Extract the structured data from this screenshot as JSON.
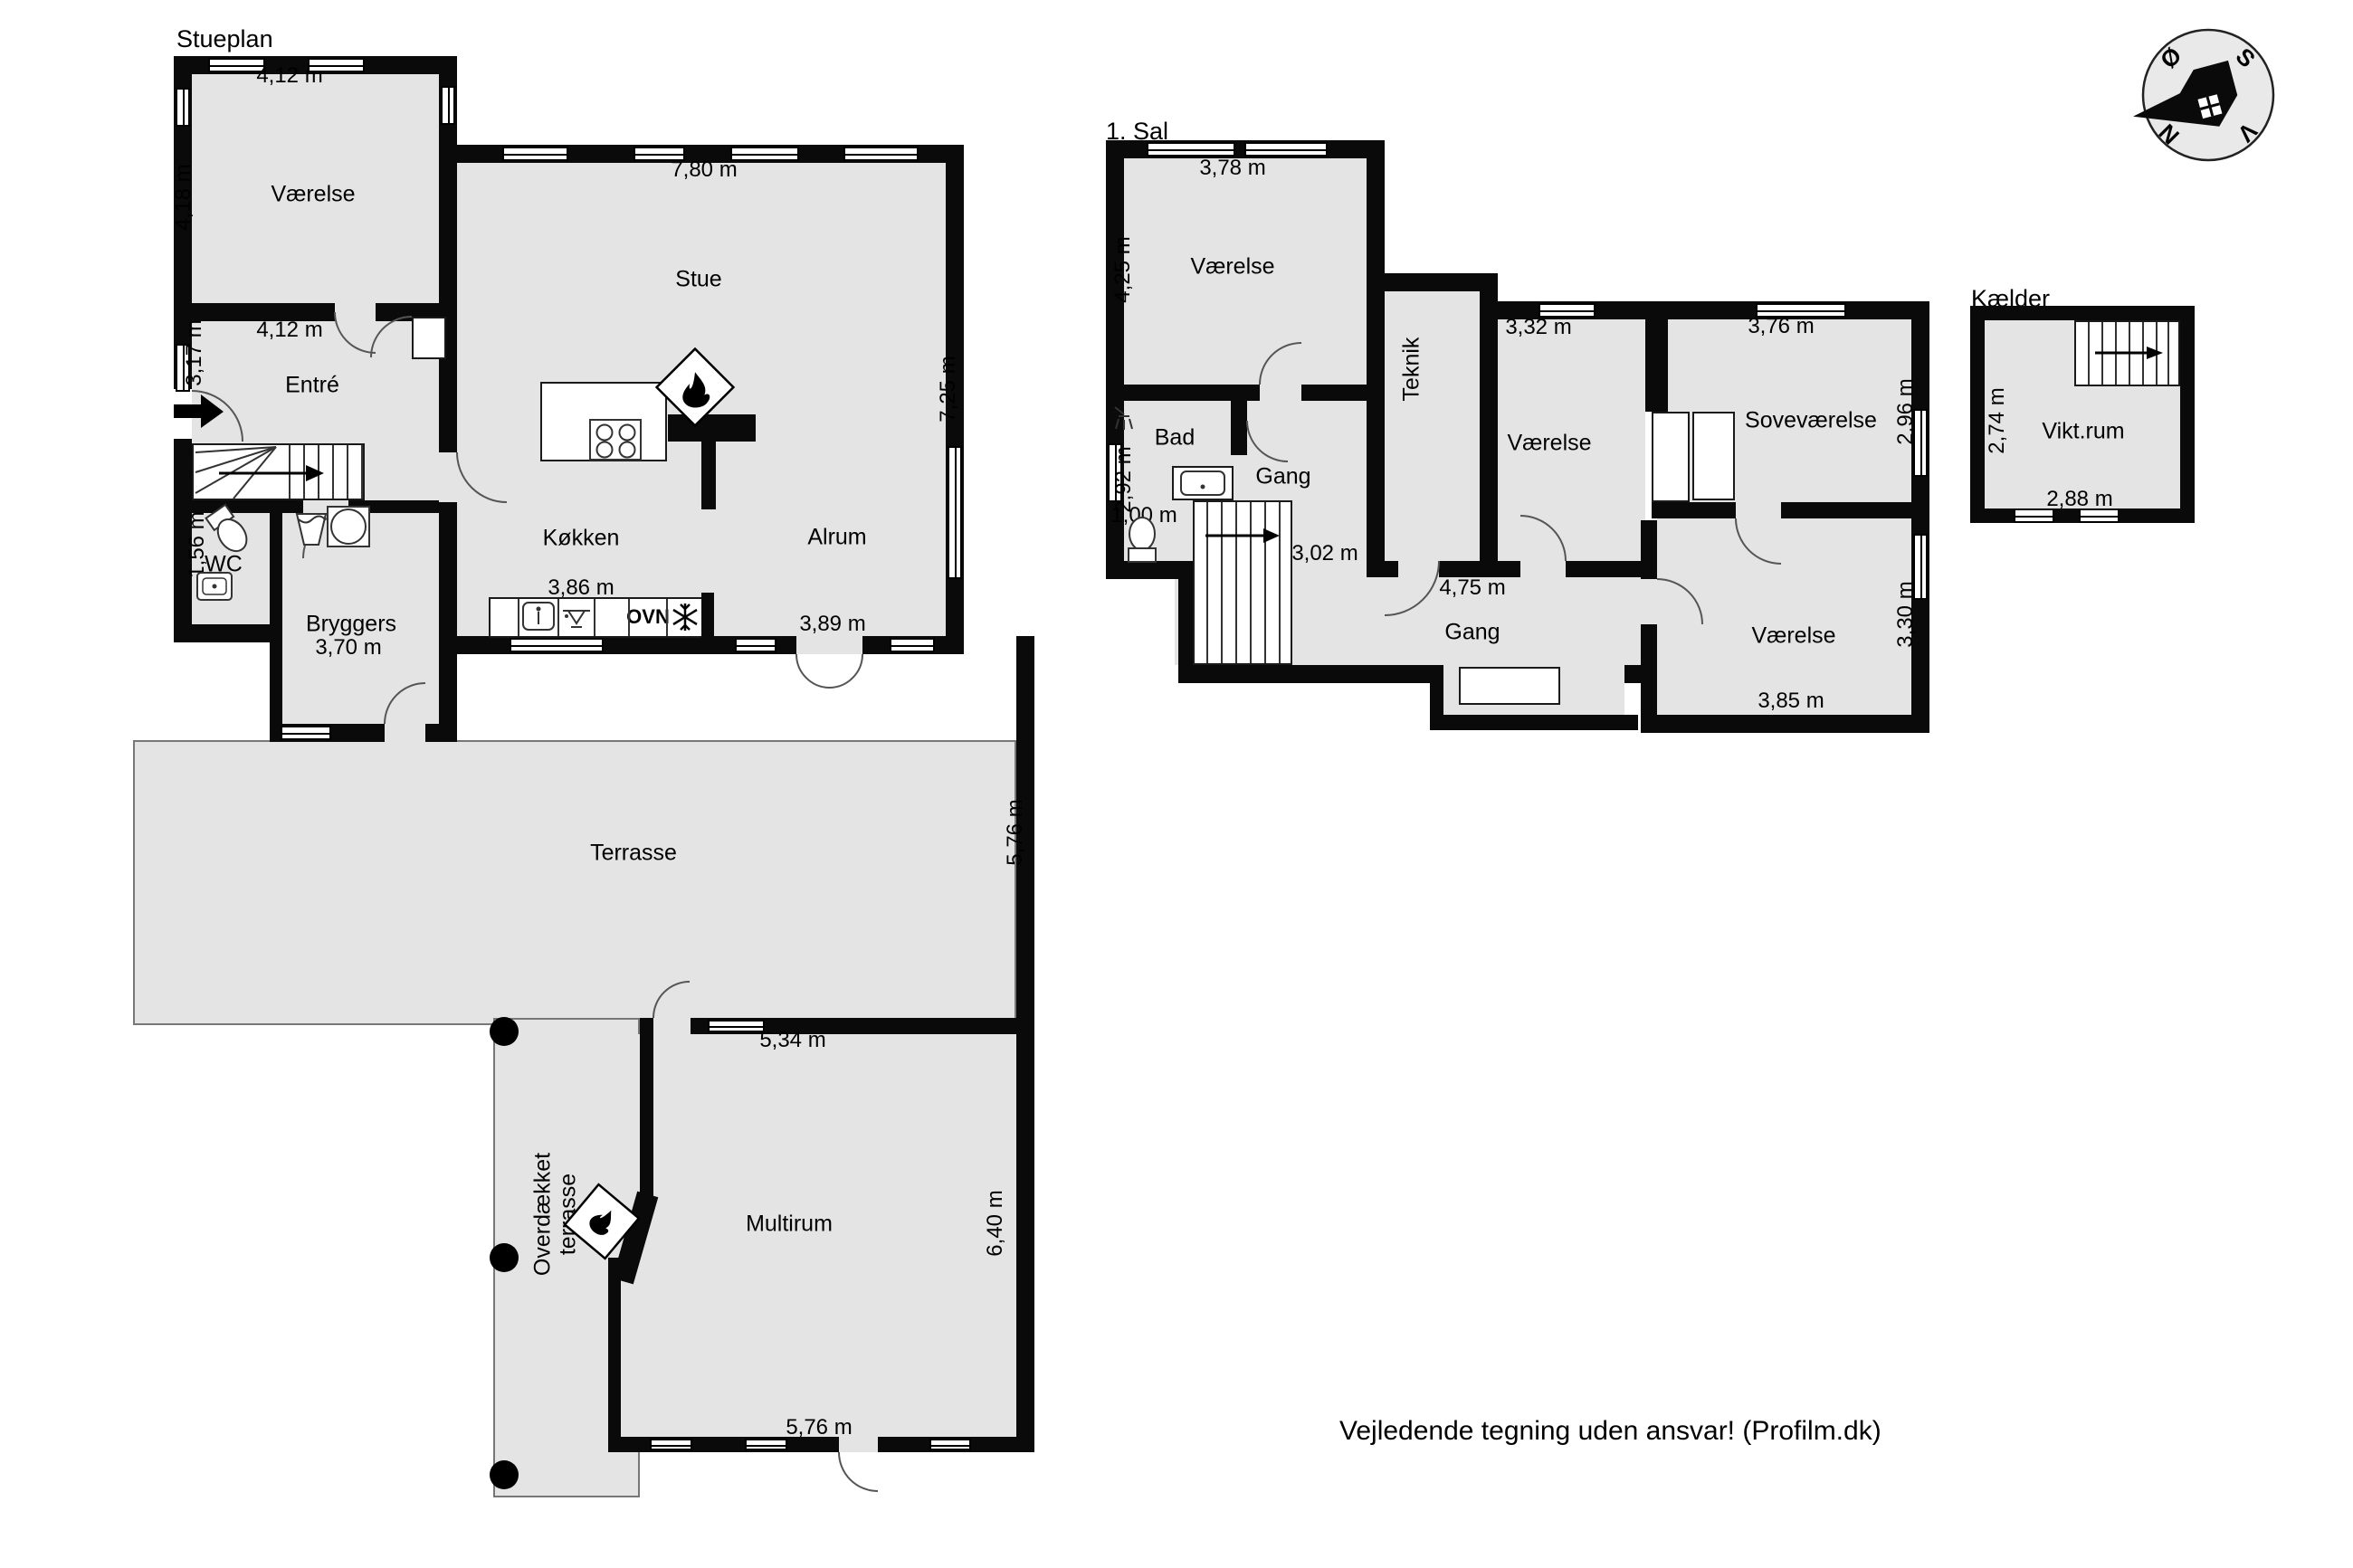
{
  "page": {
    "footer": "Vejledende tegning uden ansvar! (Profilm.dk)"
  },
  "stueplan": {
    "title": "Stueplan",
    "rooms": {
      "vaerelse_nw": "Værelse",
      "entre": "Entré",
      "wc": "WC",
      "bryggers": "Bryggers",
      "stue": "Stue",
      "koekken": "Køkken",
      "alrum": "Alrum",
      "terrasse": "Terrasse",
      "overdaekket_terrasse": "Overdækket terrasse",
      "multirum": "Multirum"
    },
    "dims": {
      "vaerelse_width": "4,12 m",
      "vaerelse_height": "4,18 m",
      "entre_width": "4,12 m",
      "entre_height": "3,17 m",
      "wc_height": "1,56 m",
      "bryggers_width": "3,70 m",
      "stue_width": "7,80 m",
      "stue_height": "7,25 m",
      "koekken_width": "3,86 m",
      "alrum_width": "3,89 m",
      "terrasse_height": "5,76 m",
      "multirum_width_top": "5,34 m",
      "multirum_height": "6,40 m",
      "multirum_width_bottom": "5,76 m"
    },
    "appliances": {
      "oven": "OVN"
    }
  },
  "sal1": {
    "title": "1. Sal",
    "rooms": {
      "vaerelse_nw": "Værelse",
      "bad": "Bad",
      "gang_upper": "Gang",
      "teknik": "Teknik",
      "vaerelse_mid": "Værelse",
      "sovevaerelse": "Soveværelse",
      "gang_lower": "Gang",
      "vaerelse_se": "Værelse"
    },
    "dims": {
      "vaerelse_nw_width": "3,78 m",
      "vaerelse_nw_height": "4,25 m",
      "bad_height": "2,92 m",
      "bad_width": "1,00 m",
      "stairs_width": "3,02 m",
      "vaerelse_mid_width": "3,32 m",
      "sovevaerelse_width": "3,76 m",
      "sovevaerelse_height": "2,96 m",
      "gang_width": "4,75 m",
      "vaerelse_se_height": "3,30 m",
      "vaerelse_se_width": "3,85 m"
    }
  },
  "kaelder": {
    "title": "Kælder",
    "rooms": {
      "viktrum": "Vikt.rum"
    },
    "dims": {
      "height": "2,74 m",
      "width": "2,88 m"
    }
  },
  "compass": {
    "north": "N",
    "east": "Ø",
    "south": "S",
    "west": "V"
  },
  "icons": {
    "fireplace": "flame-icon",
    "freezer": "snowflake-icon",
    "oven": "text-OVN",
    "sink": "sink-icon",
    "dishwasher": "dishwasher-icon",
    "toilet": "toilet-icon",
    "washer": "washing-machine-icon",
    "shower": "shower-icon",
    "entrance": "entrance-arrow-icon",
    "stairs": "stair-arrow-icon",
    "compass": "compass-rose-icon"
  }
}
